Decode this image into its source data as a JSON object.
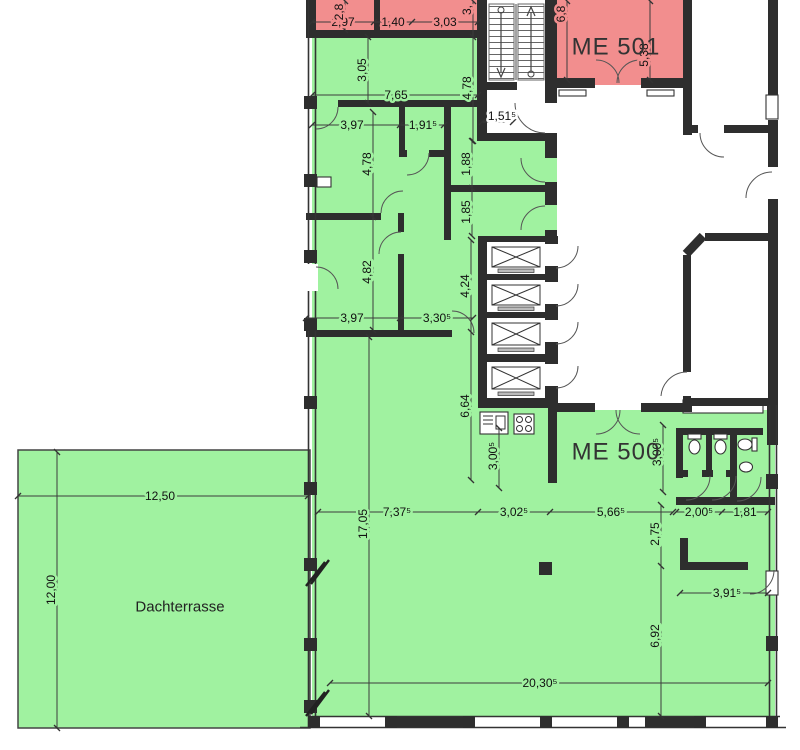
{
  "plan": {
    "labels": {
      "me500": "ME 500",
      "me501": "ME 501",
      "terrace": "Dachterrasse"
    },
    "colors": {
      "unit_green": "#a0f2a0",
      "unit_red": "#f28e8e",
      "wall": "#2e2e2e"
    },
    "dims": {
      "top_room_w_left": "2,97",
      "top_room_w_mid": "1,40",
      "top_room_w_right": "3,03",
      "top_room_h_left": "2,8",
      "top_room_h_right": "3,",
      "me501_h_left": "6,8",
      "me501_h_right": "5,38",
      "corridor_h": "3,05",
      "corridor_w": "7,65",
      "corridor_right_h": "4,78",
      "landing_w": "1,51⁵",
      "room1_w": "3,97",
      "room2_w": "1,91⁵",
      "room1_h": "4,78",
      "room3_h": "4,82",
      "room3_w": "3,97",
      "hall_w": "3,30⁵",
      "small_room1_h": "1,88",
      "small_room2_h": "1,85",
      "lift_zone_h": "4,24",
      "lift_zone_h2": "6,64",
      "kitchen_h": "3,00⁵",
      "wc_block_h": "3,00⁵",
      "wc_corridor_h": "2,75",
      "main_w1": "7,37⁵",
      "main_w2": "3,02⁵",
      "main_w3": "5,66⁵",
      "wc_w1": "2,00⁵",
      "wc_w2": "1,81",
      "right_w": "3,91⁵",
      "right_h": "6,92",
      "main_h": "17,05",
      "total_w": "20,30⁵",
      "terrace_w": "12,50",
      "terrace_h": "12,00"
    }
  }
}
